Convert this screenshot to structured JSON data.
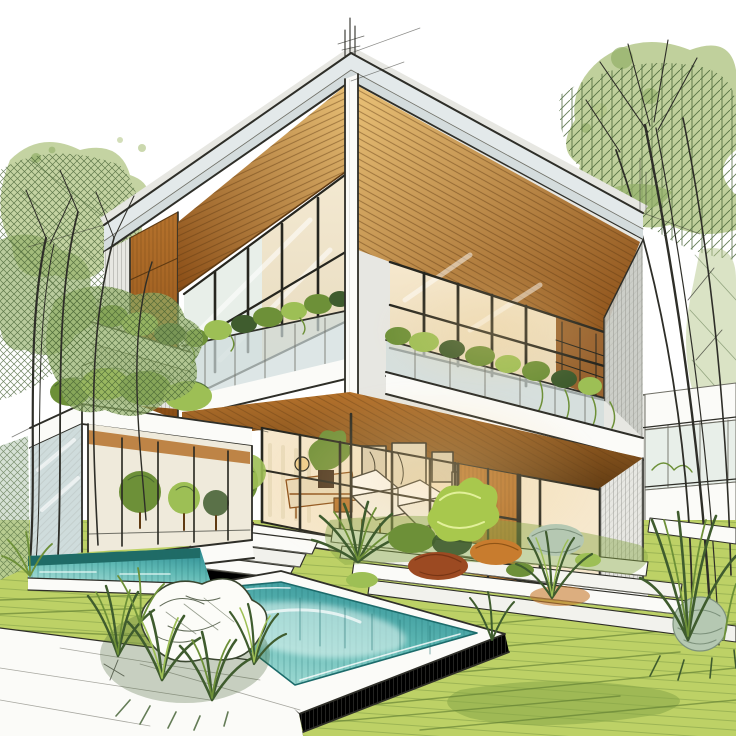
{
  "scene": {
    "type": "architectural-sketch-illustration",
    "subject": "Modern two-story cantilevered house with wood soffits, glass balconies with planters, glass garden pavilion, landscaped garden, stepped walkways and a raised swimming pool",
    "style": "hand-drawn ink line sketch with watercolor and marker rendering on white",
    "aria_label": "Architectural concept sketch of a modern house with balconies, garden and swimming pool"
  },
  "inventory": [
    "upper-floor-cantilever-volume",
    "left-balcony-recess",
    "right-balcony-recess",
    "wood-slat-ceilings",
    "glass-railings-with-planters",
    "corner-pier",
    "parapet-bands",
    "construction-antenna-lines",
    "ground-floor-glass-wall",
    "interior-lounge-furniture",
    "framed-artwork",
    "curtains",
    "wood-door-niche",
    "terrace-steps",
    "potted-topiary-tree",
    "garden-beds-mixed-shrubs",
    "agave-plant",
    "stepped-white-walkway",
    "glass-pavilion",
    "pavilion-roof-shrubs",
    "raised-pool-white-coping",
    "turquoise-water",
    "far-water-channel",
    "foreground-ornamental-grasses",
    "white-sketch-bush",
    "left-watercolor-trees",
    "right-watercolor-tree",
    "background-neighbor-building",
    "lawn-with-sketch-stripes",
    "white-paving-foreground"
  ],
  "palette": {
    "paper": "#ffffff",
    "ink": "#2e2e28",
    "ink-soft": "#6f6f66",
    "hatch": "#8f9089",
    "parapet": "#e3e9ea",
    "parapet2": "#cfd8da",
    "white": "#fbfbf8",
    "concrete": "#e7e7e2",
    "concrete-dark": "#c9cbc5",
    "wood-light": "#e9c177",
    "wood-mid": "#b5722c",
    "wood-dark": "#8a4d16",
    "wood-deep": "#5f3a12",
    "frame-dark": "#26261f",
    "warm-light": "#f6e8cd",
    "warm-glow": "#f0cf8e",
    "curtain": "#e7d8b8",
    "glass-cool": "#e8efe9",
    "glass-blue": "#cfdcdc",
    "water-deep": "#2f8e94",
    "water-mid": "#5fb9b4",
    "water-light": "#aadfd8",
    "water-line": "#1c6b6b",
    "water-far": "#3b9693",
    "water-far-dark": "#1f6b66",
    "lawn": "#bdd166",
    "lawn-light": "#d8e492",
    "lawn-line": "#5c7a2f",
    "leaf-dark": "#3f5c2e",
    "leaf-mid": "#6d9038",
    "leaf-light": "#9dbf55",
    "leaf-bright": "#a8c84d",
    "foliage-wash": "#b5c88b",
    "foliage-wash2": "#93af68",
    "sage": "#b5c8b2",
    "rust": "#9c4a22",
    "orange": "#c87c2e",
    "pot-dark": "#46321f",
    "shadow-green": "#87a647"
  }
}
